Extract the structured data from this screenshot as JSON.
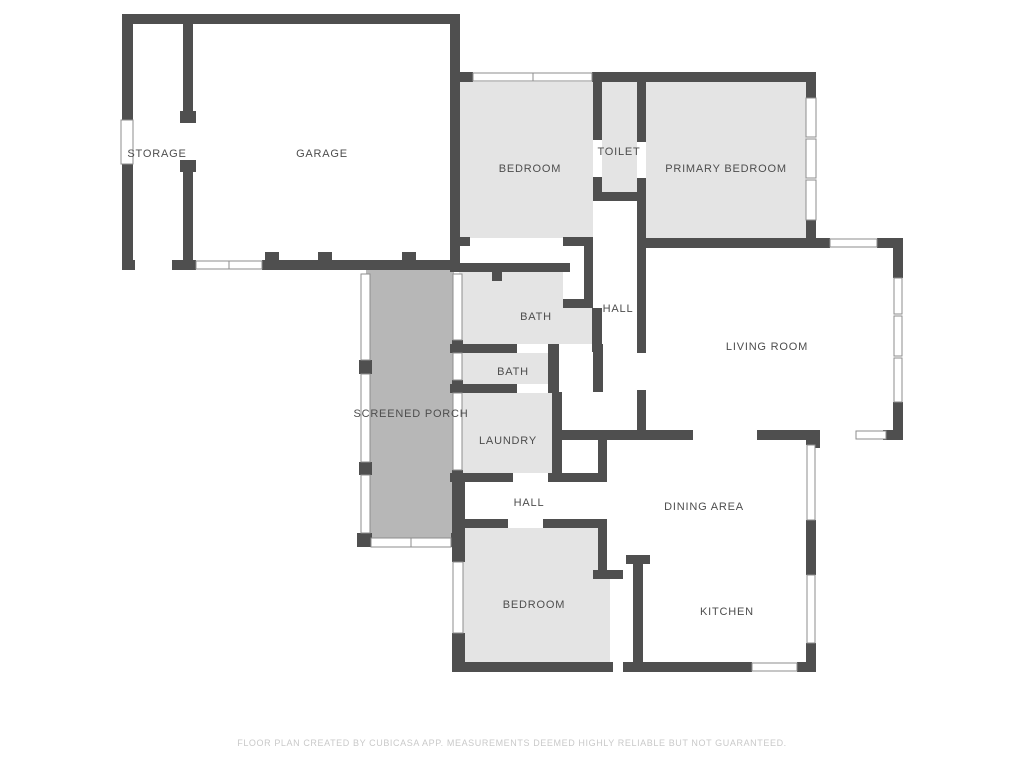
{
  "footer": {
    "text": "FLOOR PLAN CREATED BY CUBICASA APP. MEASUREMENTS DEEMED HIGHLY RELIABLE BUT NOT GUARANTEED."
  },
  "colors": {
    "wall": "#4f4f4f",
    "room": "#e4e4e4",
    "porch": "#b7b7b7",
    "bg": "#ffffff",
    "window_frame": "#8e8e8e",
    "label": "#4d4d4d",
    "footer": "#c9c9c9"
  },
  "canvas": {
    "w": 1024,
    "h": 768
  },
  "rooms": [
    {
      "name": "storage",
      "label": "STORAGE",
      "lx": 157,
      "ly": 157
    },
    {
      "name": "garage",
      "label": "GARAGE",
      "lx": 322,
      "ly": 157
    },
    {
      "name": "bedroom-top",
      "label": "BEDROOM",
      "lx": 530,
      "ly": 172
    },
    {
      "name": "toilet",
      "label": "TOILET",
      "lx": 619,
      "ly": 155
    },
    {
      "name": "primary-bedroom",
      "label": "PRIMARY BEDROOM",
      "lx": 726,
      "ly": 172
    },
    {
      "name": "hall-upper",
      "label": "HALL",
      "lx": 618,
      "ly": 312
    },
    {
      "name": "living-room",
      "label": "LIVING ROOM",
      "lx": 767,
      "ly": 350
    },
    {
      "name": "bath-1",
      "label": "BATH",
      "lx": 536,
      "ly": 320
    },
    {
      "name": "bath-2",
      "label": "BATH",
      "lx": 513,
      "ly": 375
    },
    {
      "name": "screened-porch",
      "label": "SCREENED PORCH",
      "lx": 411,
      "ly": 417
    },
    {
      "name": "laundry",
      "label": "LAUNDRY",
      "lx": 508,
      "ly": 444
    },
    {
      "name": "hall-lower",
      "label": "HALL",
      "lx": 529,
      "ly": 506
    },
    {
      "name": "dining-area",
      "label": "DINING AREA",
      "lx": 704,
      "ly": 510
    },
    {
      "name": "bedroom-bottom",
      "label": "BEDROOM",
      "lx": 534,
      "ly": 608
    },
    {
      "name": "kitchen",
      "label": "KITCHEN",
      "lx": 727,
      "ly": 615
    }
  ],
  "fills": [
    {
      "name": "bedroom-top-fill",
      "x": 460,
      "y": 82,
      "w": 133,
      "h": 156,
      "color": "room"
    },
    {
      "name": "toilet-fill",
      "x": 602,
      "y": 82,
      "w": 35,
      "h": 110,
      "color": "room"
    },
    {
      "name": "primary-bedroom-fill",
      "x": 646,
      "y": 82,
      "w": 160,
      "h": 156,
      "color": "room"
    },
    {
      "name": "bath-1-fill",
      "x": 459,
      "y": 272,
      "w": 133,
      "h": 72,
      "color": "room"
    },
    {
      "name": "bath-2-fill",
      "x": 459,
      "y": 353,
      "w": 89,
      "h": 31,
      "color": "room"
    },
    {
      "name": "laundry-fill",
      "x": 459,
      "y": 393,
      "w": 93,
      "h": 80,
      "color": "room"
    },
    {
      "name": "screened-porch-fill",
      "x": 366,
      "y": 268,
      "w": 88,
      "h": 270,
      "color": "porch"
    },
    {
      "name": "bedroom-bottom-fill",
      "x": 462,
      "y": 528,
      "w": 136,
      "h": 134,
      "color": "room"
    },
    {
      "name": "bedroom-bottom-ext",
      "x": 598,
      "y": 578,
      "w": 12,
      "h": 84,
      "color": "room"
    },
    {
      "name": "closet-interior",
      "x": 563,
      "y": 246,
      "w": 21,
      "h": 53,
      "color": "bg"
    }
  ],
  "walls": [
    [
      122,
      14,
      338,
      10
    ],
    [
      122,
      24,
      11,
      96
    ],
    [
      122,
      164,
      11,
      106
    ],
    [
      183,
      24,
      10,
      99
    ],
    [
      180,
      111,
      16,
      12
    ],
    [
      183,
      160,
      10,
      100
    ],
    [
      180,
      160,
      16,
      12
    ],
    [
      122,
      260,
      13,
      10
    ],
    [
      172,
      260,
      24,
      10
    ],
    [
      262,
      260,
      198,
      10
    ],
    [
      265,
      252,
      14,
      9
    ],
    [
      318,
      252,
      14,
      9
    ],
    [
      402,
      252,
      14,
      9
    ],
    [
      450,
      14,
      10,
      246
    ],
    [
      455,
      72,
      18,
      10
    ],
    [
      592,
      72,
      54,
      10
    ],
    [
      646,
      72,
      161,
      10
    ],
    [
      806,
      72,
      10,
      26
    ],
    [
      806,
      220,
      10,
      27
    ],
    [
      637,
      238,
      193,
      10
    ],
    [
      877,
      238,
      26,
      10
    ],
    [
      893,
      238,
      10,
      40
    ],
    [
      893,
      402,
      10,
      38
    ],
    [
      637,
      430,
      56,
      10
    ],
    [
      757,
      430,
      63,
      10
    ],
    [
      808,
      440,
      12,
      8
    ],
    [
      883,
      430,
      20,
      10
    ],
    [
      593,
      82,
      9,
      58
    ],
    [
      593,
      177,
      9,
      15
    ],
    [
      637,
      82,
      9,
      60
    ],
    [
      637,
      178,
      9,
      14
    ],
    [
      593,
      192,
      53,
      9
    ],
    [
      637,
      192,
      9,
      161
    ],
    [
      637,
      390,
      9,
      50
    ],
    [
      450,
      237,
      20,
      9
    ],
    [
      563,
      237,
      30,
      9
    ],
    [
      584,
      246,
      9,
      62
    ],
    [
      563,
      299,
      30,
      9
    ],
    [
      592,
      308,
      10,
      44
    ],
    [
      450,
      263,
      120,
      9
    ],
    [
      492,
      272,
      10,
      9
    ],
    [
      450,
      344,
      67,
      9
    ],
    [
      548,
      344,
      11,
      9
    ],
    [
      548,
      344,
      11,
      48
    ],
    [
      450,
      384,
      67,
      9
    ],
    [
      548,
      384,
      11,
      9
    ],
    [
      593,
      344,
      10,
      48
    ],
    [
      552,
      392,
      10,
      81
    ],
    [
      552,
      430,
      95,
      10
    ],
    [
      598,
      440,
      9,
      35
    ],
    [
      450,
      473,
      63,
      9
    ],
    [
      548,
      473,
      59,
      9
    ],
    [
      452,
      473,
      13,
      56
    ],
    [
      452,
      519,
      56,
      9
    ],
    [
      543,
      519,
      64,
      9
    ],
    [
      452,
      529,
      13,
      33
    ],
    [
      452,
      633,
      13,
      38
    ],
    [
      598,
      519,
      9,
      59
    ],
    [
      593,
      570,
      30,
      9
    ],
    [
      452,
      662,
      161,
      10
    ],
    [
      623,
      662,
      129,
      10
    ],
    [
      797,
      662,
      18,
      10
    ],
    [
      633,
      555,
      10,
      112
    ],
    [
      626,
      555,
      24,
      9
    ],
    [
      806,
      432,
      10,
      13
    ],
    [
      806,
      520,
      10,
      55
    ],
    [
      806,
      643,
      10,
      29
    ],
    [
      359,
      360,
      13,
      14
    ],
    [
      359,
      462,
      13,
      13
    ],
    [
      357,
      533,
      15,
      14
    ],
    [
      451,
      533,
      14,
      14
    ],
    [
      452,
      340,
      11,
      13
    ],
    [
      452,
      380,
      11,
      13
    ],
    [
      452,
      470,
      11,
      13
    ]
  ],
  "windows": [
    [
      121,
      120,
      12,
      44
    ],
    [
      196,
      261,
      33,
      8
    ],
    [
      229,
      261,
      33,
      8
    ],
    [
      473,
      73,
      60,
      8
    ],
    [
      533,
      73,
      59,
      8
    ],
    [
      806,
      98,
      10,
      39
    ],
    [
      806,
      139,
      10,
      39
    ],
    [
      806,
      180,
      10,
      40
    ],
    [
      830,
      239,
      47,
      8
    ],
    [
      894,
      278,
      8,
      36
    ],
    [
      894,
      316,
      8,
      40
    ],
    [
      894,
      358,
      8,
      44
    ],
    [
      856,
      431,
      30,
      8
    ],
    [
      807,
      445,
      8,
      75
    ],
    [
      807,
      575,
      8,
      68
    ],
    [
      752,
      663,
      45,
      8
    ],
    [
      361,
      274,
      9,
      86
    ],
    [
      361,
      374,
      9,
      88
    ],
    [
      361,
      475,
      9,
      58
    ],
    [
      371,
      538,
      40,
      9
    ],
    [
      411,
      538,
      40,
      9
    ],
    [
      453,
      274,
      9,
      66
    ],
    [
      453,
      353,
      9,
      27
    ],
    [
      453,
      393,
      9,
      77
    ],
    [
      453,
      562,
      10,
      71
    ]
  ]
}
